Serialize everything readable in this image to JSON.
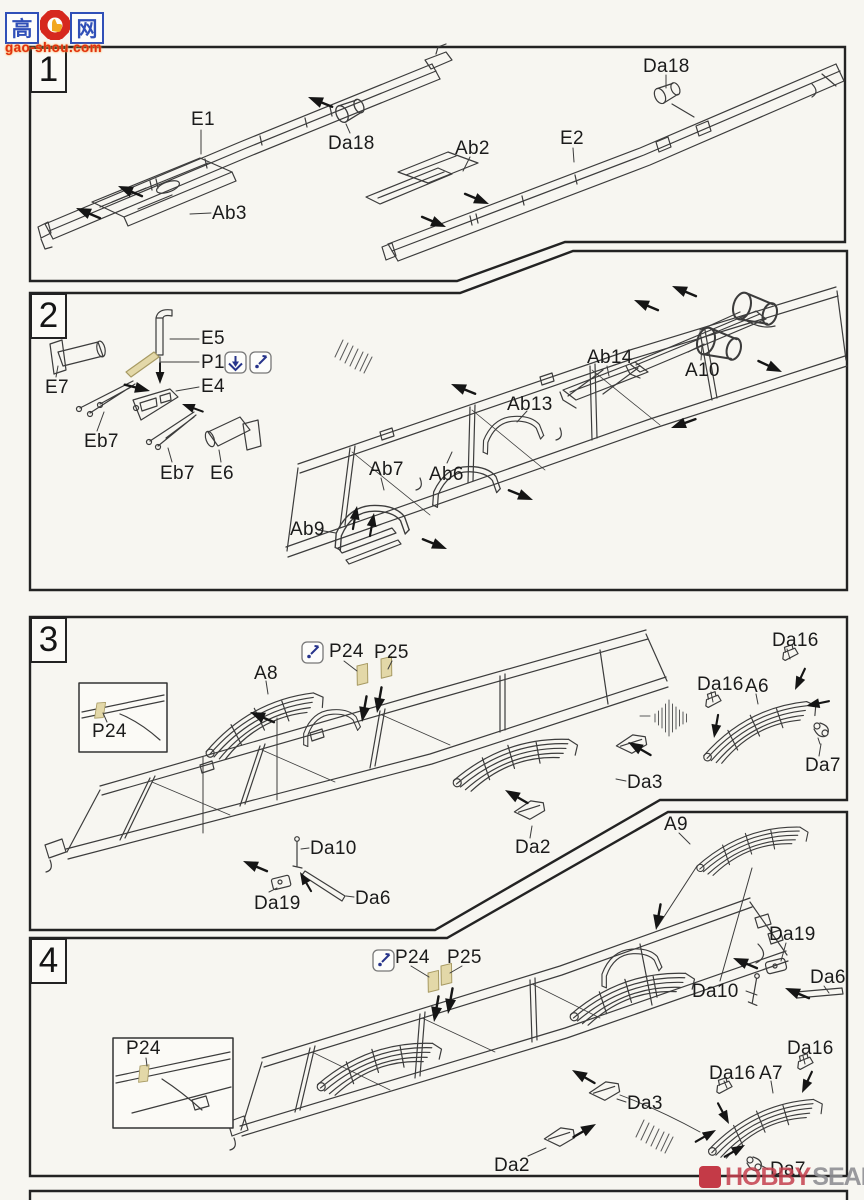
{
  "steps": [
    {
      "number": "1",
      "labels": [
        "E1",
        "Da18",
        "Ab3",
        "Ab2",
        "E2",
        "Da18"
      ]
    },
    {
      "number": "2",
      "labels": [
        "E5",
        "P1",
        "E4",
        "E7",
        "Eb7",
        "Eb7",
        "E6",
        "Ab9",
        "Ab7",
        "Ab6",
        "Ab13",
        "Ab14",
        "A10"
      ]
    },
    {
      "number": "3",
      "labels": [
        "P24",
        "P25",
        "A8",
        "P24",
        "Da16",
        "Da16",
        "A6",
        "Da7",
        "Da3",
        "Da2",
        "Da10",
        "Da19",
        "Da6"
      ]
    },
    {
      "number": "4",
      "labels": [
        "P24",
        "P25",
        "P24",
        "A9",
        "Da19",
        "Da6",
        "Da10",
        "Da16",
        "Da16",
        "A7",
        "Da3",
        "Da2",
        "Da7"
      ]
    }
  ],
  "watermarks": {
    "gao_shou": {
      "left_char": "高",
      "right_char": "网",
      "domain": "gao-shou.com"
    },
    "hobby_search": {
      "word1": "HOBBY",
      "word2": "SEARCH"
    }
  },
  "icons": {
    "bend_icon": "fold-down-arrow",
    "glue_icon": "glue-applicator"
  },
  "colors": {
    "photo_etch_tan": "#e3d8a8",
    "icon_blue": "#27348b",
    "line_gray": "#3c3c3c",
    "logo_red": "#d6281e",
    "logo_blue": "#3050b8",
    "hobby_red": "#c5404e",
    "hobby_gray": "#8f9094"
  }
}
